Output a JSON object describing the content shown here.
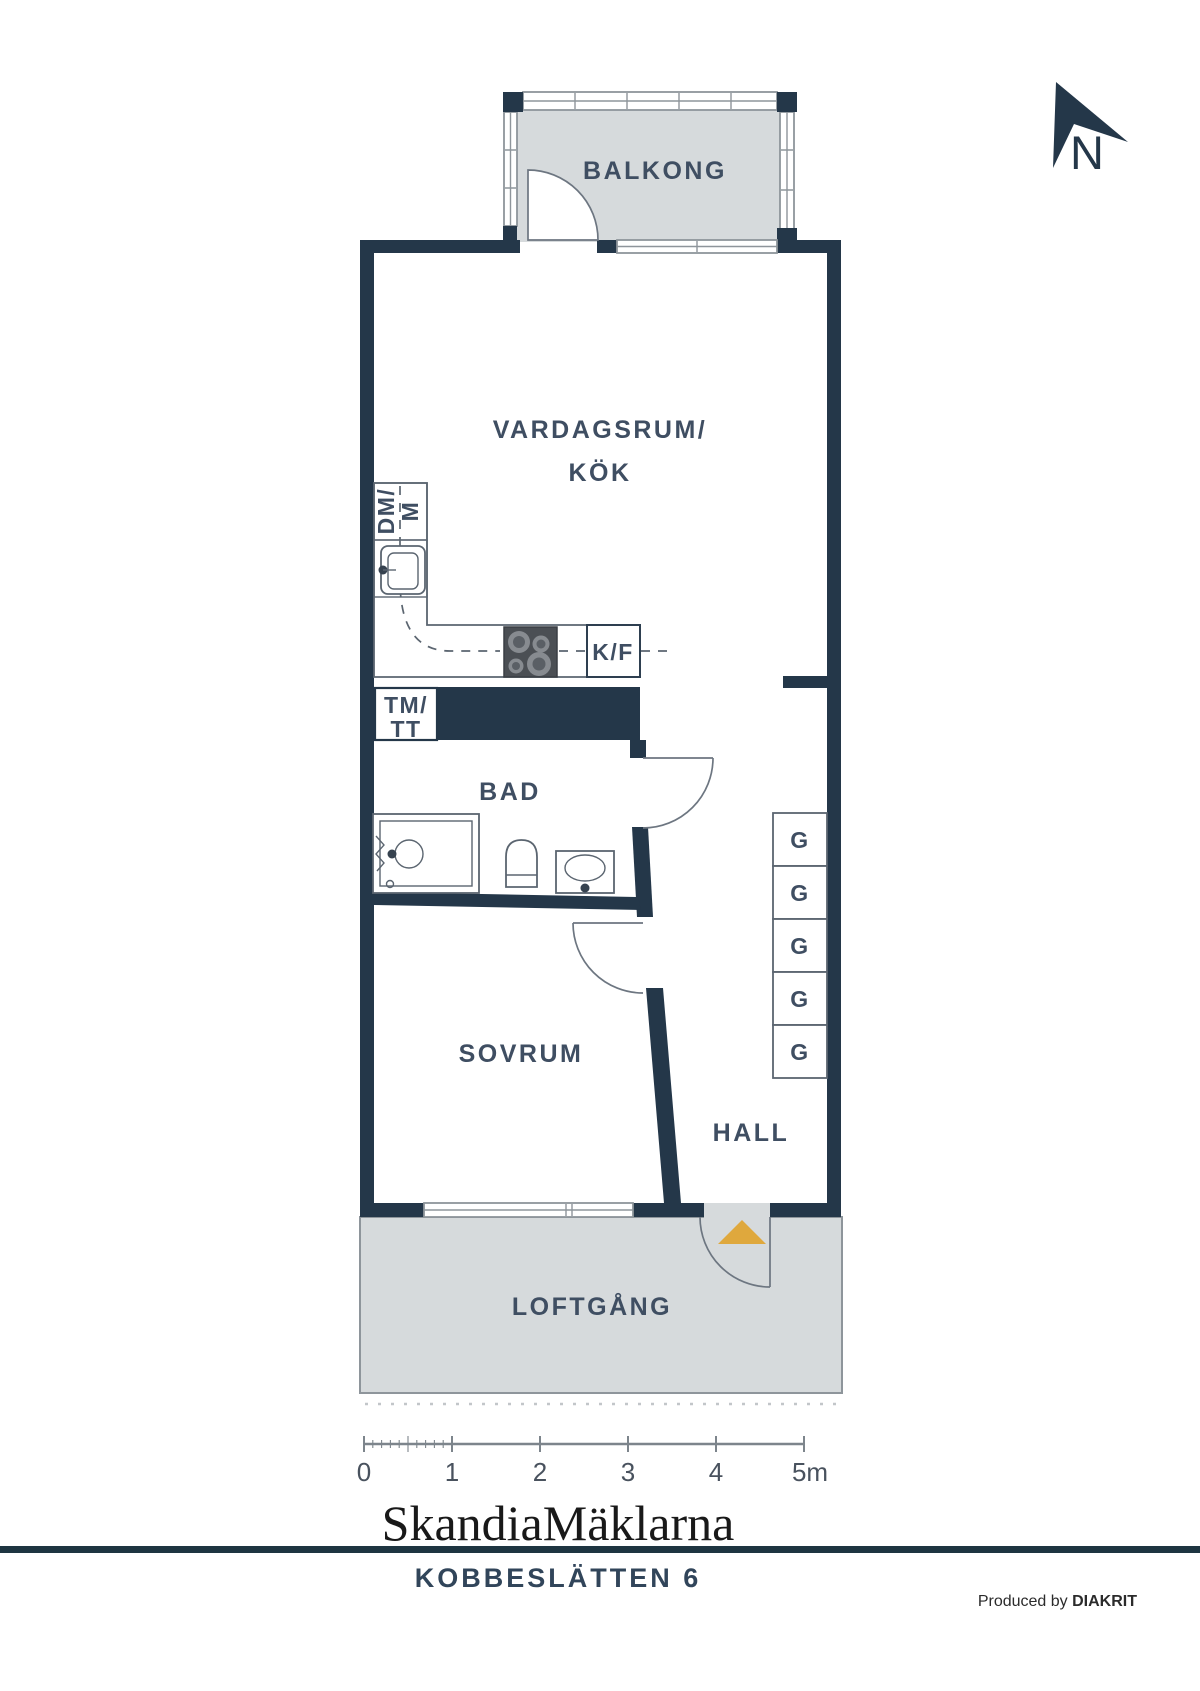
{
  "colors": {
    "wall": "#243749",
    "label": "#3F4E62",
    "floor": "#D6DADC",
    "line": "#8E959B",
    "accent": "#DFA83D"
  },
  "north": {
    "label": "N"
  },
  "rooms": {
    "balcony": "BALKONG",
    "living_line1": "VARDAGSRUM/",
    "living_line2": "KÖK",
    "bathroom": "BAD",
    "bedroom": "SOVRUM",
    "hall": "HALL",
    "walkway": "LOFTGÅNG"
  },
  "fixtures": {
    "fridge_freezer": "K/F",
    "dishwasher_line1": "DM/",
    "dishwasher_line2": "M",
    "washer_line1": "TM/",
    "washer_line2": "TT",
    "wardrobe": "G"
  },
  "scale_bar": {
    "ticks": [
      "0",
      "1",
      "2",
      "3",
      "4",
      "5m"
    ]
  },
  "footer": {
    "brand": "SkandiaMäklarna",
    "address": "KOBBESLÄTTEN 6",
    "produced_prefix": "Produced by ",
    "producer": "DIAKRIT"
  }
}
